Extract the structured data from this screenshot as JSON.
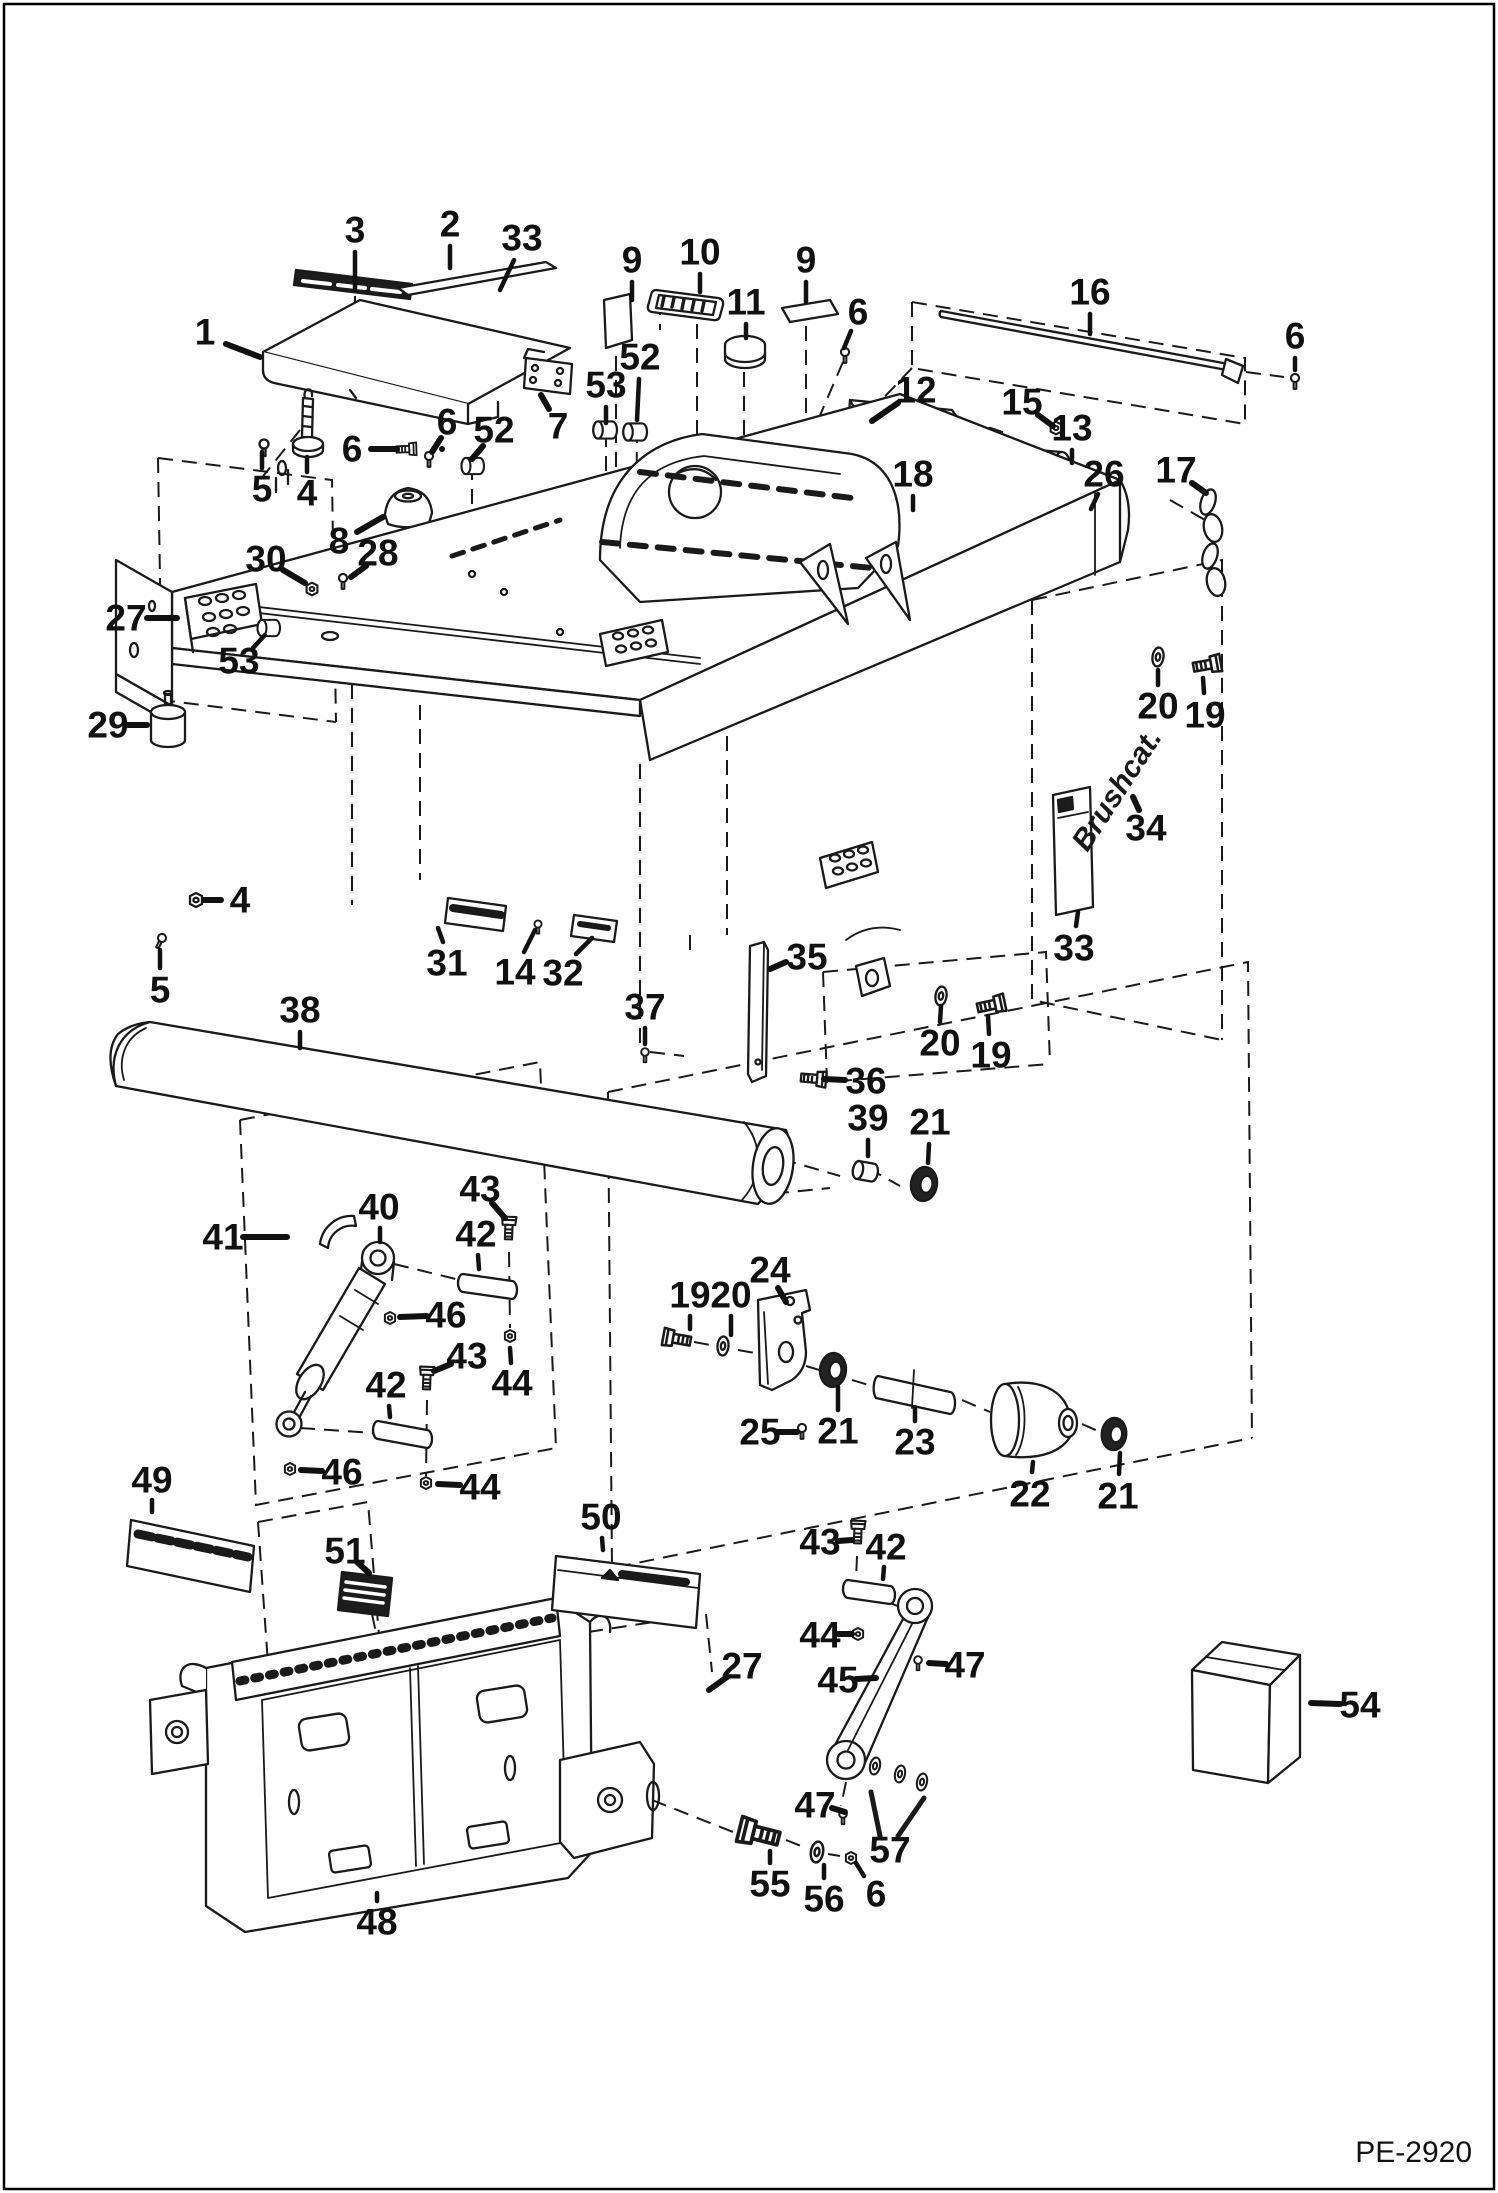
{
  "page": {
    "background": "#ffffff",
    "line_color": "#1a1a1a",
    "border_color": "#000000"
  },
  "footer": {
    "code": "PE-2920"
  },
  "brand": {
    "logo_text": "Brushcat."
  },
  "diagram": {
    "type": "exploded-parts-diagram",
    "part_numbers_shown": [
      1,
      2,
      3,
      4,
      5,
      6,
      7,
      8,
      9,
      10,
      11,
      12,
      13,
      14,
      15,
      16,
      17,
      18,
      19,
      20,
      21,
      22,
      23,
      24,
      25,
      26,
      27,
      28,
      29,
      30,
      31,
      32,
      33,
      34,
      35,
      36,
      37,
      38,
      39,
      40,
      41,
      42,
      43,
      44,
      45,
      46,
      47,
      48,
      49,
      50,
      51,
      52,
      53,
      54,
      55,
      56,
      57
    ],
    "callouts": [
      {
        "label": "1",
        "x": 205,
        "y": 332,
        "leaders": [
          [
            226,
            344,
            260,
            357
          ]
        ],
        "thick": true
      },
      {
        "label": "3",
        "x": 355,
        "y": 230,
        "leaders": [
          [
            355,
            252,
            355,
            290
          ]
        ]
      },
      {
        "label": "2",
        "x": 450,
        "y": 224,
        "leaders": [
          [
            450,
            246,
            450,
            268
          ]
        ]
      },
      {
        "label": "33",
        "x": 522,
        "y": 238,
        "leaders": [
          [
            514,
            260,
            500,
            290
          ]
        ]
      },
      {
        "label": "9",
        "x": 632,
        "y": 260,
        "leaders": [
          [
            632,
            282,
            632,
            300
          ]
        ]
      },
      {
        "label": "10",
        "x": 700,
        "y": 252,
        "leaders": [
          [
            700,
            274,
            700,
            292
          ]
        ]
      },
      {
        "label": "11",
        "x": 746,
        "y": 302,
        "leaders": [
          [
            746,
            324,
            746,
            338
          ]
        ]
      },
      {
        "label": "9",
        "x": 806,
        "y": 260,
        "leaders": [
          [
            806,
            282,
            806,
            302
          ]
        ]
      },
      {
        "label": "6",
        "x": 858,
        "y": 312,
        "leaders": [
          [
            851,
            331,
            844,
            348
          ]
        ]
      },
      {
        "label": "16",
        "x": 1090,
        "y": 292,
        "leaders": [
          [
            1090,
            314,
            1090,
            334
          ]
        ]
      },
      {
        "label": "6",
        "x": 1295,
        "y": 336,
        "leaders": [
          [
            1295,
            358,
            1295,
            370
          ]
        ]
      },
      {
        "label": "12",
        "x": 916,
        "y": 390,
        "leaders": [
          [
            898,
            403,
            872,
            421
          ]
        ],
        "thick": true
      },
      {
        "label": "15",
        "x": 1022,
        "y": 402,
        "leaders": [
          [
            1038,
            415,
            1053,
            426
          ]
        ],
        "thick": true
      },
      {
        "label": "13",
        "x": 1072,
        "y": 428,
        "leaders": [
          [
            1072,
            450,
            1072,
            463
          ]
        ]
      },
      {
        "label": "26",
        "x": 1104,
        "y": 474,
        "leaders": [
          [
            1098,
            494,
            1091,
            509
          ]
        ]
      },
      {
        "label": "17",
        "x": 1176,
        "y": 470,
        "leaders": [
          [
            1192,
            483,
            1206,
            493
          ]
        ],
        "thick": true
      },
      {
        "label": "18",
        "x": 913,
        "y": 474,
        "leaders": [
          [
            913,
            496,
            913,
            510
          ]
        ]
      },
      {
        "label": "5",
        "x": 262,
        "y": 489,
        "leaders": [
          [
            262,
            468,
            262,
            452
          ]
        ]
      },
      {
        "label": "4",
        "x": 307,
        "y": 493,
        "leaders": [
          [
            307,
            472,
            307,
            457
          ]
        ]
      },
      {
        "label": "6",
        "x": 352,
        "y": 449,
        "leaders": [
          [
            371,
            449,
            397,
            449
          ],
          [
            442,
            449,
            442,
            449
          ]
        ],
        "thick": true
      },
      {
        "label": "6",
        "x": 447,
        "y": 422,
        "leaders": [
          [
            441,
            438,
            432,
            452
          ]
        ],
        "thick": true
      },
      {
        "label": "52",
        "x": 494,
        "y": 430,
        "leaders": [
          [
            483,
            446,
            472,
            459
          ]
        ],
        "thick": true
      },
      {
        "label": "53",
        "x": 606,
        "y": 385,
        "leaders": [
          [
            606,
            407,
            606,
            423
          ]
        ]
      },
      {
        "label": "52",
        "x": 640,
        "y": 357,
        "leaders": [
          [
            639,
            379,
            637,
            420
          ]
        ]
      },
      {
        "label": "7",
        "x": 558,
        "y": 426,
        "leaders": [
          [
            549,
            409,
            541,
            395
          ]
        ],
        "thick": true
      },
      {
        "label": "8",
        "x": 339,
        "y": 541,
        "leaders": [
          [
            357,
            532,
            383,
            517
          ]
        ],
        "thick": true
      },
      {
        "label": "28",
        "x": 378,
        "y": 553,
        "leaders": [
          [
            366,
            566,
            351,
            577
          ]
        ],
        "thick": true
      },
      {
        "label": "30",
        "x": 266,
        "y": 559,
        "leaders": [
          [
            283,
            570,
            305,
            583
          ]
        ],
        "thick": true
      },
      {
        "label": "27",
        "x": 126,
        "y": 618,
        "leaders": [
          [
            147,
            618,
            177,
            618
          ]
        ],
        "thick": true
      },
      {
        "label": "53",
        "x": 239,
        "y": 661,
        "leaders": [
          [
            253,
            648,
            265,
            635
          ]
        ]
      },
      {
        "label": "29",
        "x": 108,
        "y": 725,
        "leaders": [
          [
            128,
            725,
            147,
            725
          ],
          [
            0,
            0,
            0,
            0
          ]
        ],
        "thick": true
      },
      {
        "label": "4",
        "x": 240,
        "y": 900,
        "leaders": [
          [
            221,
            900,
            204,
            900
          ]
        ],
        "thick": true
      },
      {
        "label": "5",
        "x": 160,
        "y": 990,
        "leaders": [
          [
            160,
            968,
            160,
            950
          ]
        ]
      },
      {
        "label": "31",
        "x": 447,
        "y": 963,
        "leaders": [
          [
            443,
            942,
            438,
            928
          ]
        ]
      },
      {
        "label": "14",
        "x": 515,
        "y": 972,
        "leaders": [
          [
            524,
            952,
            535,
            930
          ]
        ]
      },
      {
        "label": "32",
        "x": 563,
        "y": 973,
        "leaders": [
          [
            576,
            954,
            592,
            938
          ]
        ]
      },
      {
        "label": "35",
        "x": 807,
        "y": 957,
        "leaders": [
          [
            786,
            962,
            770,
            969
          ]
        ],
        "thick": true
      },
      {
        "label": "36",
        "x": 866,
        "y": 1081,
        "leaders": [
          [
            845,
            1080,
            824,
            1079
          ]
        ],
        "thick": true
      },
      {
        "label": "37",
        "x": 645,
        "y": 1007,
        "leaders": [
          [
            645,
            1028,
            645,
            1044
          ]
        ]
      },
      {
        "label": "38",
        "x": 300,
        "y": 1010,
        "leaders": [
          [
            300,
            1032,
            300,
            1048
          ]
        ]
      },
      {
        "label": "20",
        "x": 1158,
        "y": 706,
        "leaders": [
          [
            1158,
            685,
            1158,
            670
          ]
        ]
      },
      {
        "label": "19",
        "x": 1205,
        "y": 715,
        "leaders": [
          [
            1204,
            693,
            1203,
            678
          ]
        ]
      },
      {
        "label": "34",
        "x": 1146,
        "y": 828,
        "leaders": [
          [
            1139,
            810,
            1133,
            797
          ]
        ],
        "thick": true
      },
      {
        "label": "33",
        "x": 1074,
        "y": 948,
        "leaders": [
          [
            1076,
            926,
            1078,
            912
          ]
        ]
      },
      {
        "label": "20",
        "x": 940,
        "y": 1043,
        "leaders": [
          [
            940,
            1022,
            941,
            1006
          ]
        ]
      },
      {
        "label": "19",
        "x": 991,
        "y": 1055,
        "leaders": [
          [
            989,
            1034,
            988,
            1016
          ]
        ]
      },
      {
        "label": "39",
        "x": 868,
        "y": 1118,
        "leaders": [
          [
            868,
            1140,
            868,
            1156
          ]
        ]
      },
      {
        "label": "21",
        "x": 930,
        "y": 1122,
        "leaders": [
          [
            929,
            1144,
            928,
            1163
          ]
        ]
      },
      {
        "label": "24",
        "x": 770,
        "y": 1270,
        "leaders": [
          [
            778,
            1288,
            786,
            1302
          ]
        ],
        "thick": true
      },
      {
        "label": "19",
        "x": 690,
        "y": 1295,
        "leaders": [
          [
            690,
            1316,
            690,
            1329
          ]
        ]
      },
      {
        "label": "20",
        "x": 731,
        "y": 1295,
        "leaders": [
          [
            731,
            1316,
            731,
            1335
          ]
        ]
      },
      {
        "label": "25",
        "x": 760,
        "y": 1432,
        "leaders": [
          [
            778,
            1432,
            797,
            1432
          ]
        ],
        "thick": true
      },
      {
        "label": "21",
        "x": 838,
        "y": 1431,
        "leaders": [
          [
            838,
            1410,
            838,
            1387
          ]
        ]
      },
      {
        "label": "23",
        "x": 915,
        "y": 1442,
        "leaders": [
          [
            915,
            1421,
            915,
            1407
          ]
        ]
      },
      {
        "label": "22",
        "x": 1030,
        "y": 1494,
        "leaders": [
          [
            1032,
            1472,
            1033,
            1462
          ]
        ]
      },
      {
        "label": "21",
        "x": 1118,
        "y": 1496,
        "leaders": [
          [
            1119,
            1474,
            1120,
            1453
          ]
        ]
      },
      {
        "label": "41",
        "x": 223,
        "y": 1237,
        "leaders": [
          [
            243,
            1237,
            287,
            1237
          ]
        ],
        "thick": true
      },
      {
        "label": "40",
        "x": 379,
        "y": 1207,
        "leaders": [
          [
            380,
            1228,
            380,
            1242
          ]
        ]
      },
      {
        "label": "43",
        "x": 480,
        "y": 1189,
        "leaders": [
          [
            492,
            1203,
            505,
            1218
          ]
        ],
        "thick": true
      },
      {
        "label": "42",
        "x": 476,
        "y": 1234,
        "leaders": [
          [
            478,
            1255,
            479,
            1269
          ]
        ]
      },
      {
        "label": "46",
        "x": 446,
        "y": 1315,
        "leaders": [
          [
            427,
            1316,
            400,
            1317
          ]
        ],
        "thick": true
      },
      {
        "label": "43",
        "x": 467,
        "y": 1356,
        "leaders": [
          [
            451,
            1364,
            434,
            1371
          ]
        ],
        "thick": true
      },
      {
        "label": "42",
        "x": 386,
        "y": 1385,
        "leaders": [
          [
            389,
            1406,
            390,
            1417
          ]
        ]
      },
      {
        "label": "44",
        "x": 512,
        "y": 1383,
        "leaders": [
          [
            511,
            1363,
            510,
            1348
          ]
        ]
      },
      {
        "label": "46",
        "x": 342,
        "y": 1472,
        "leaders": [
          [
            322,
            1471,
            301,
            1470
          ]
        ],
        "thick": true
      },
      {
        "label": "44",
        "x": 480,
        "y": 1487,
        "leaders": [
          [
            460,
            1485,
            438,
            1484
          ]
        ],
        "thick": true
      },
      {
        "label": "49",
        "x": 152,
        "y": 1480,
        "leaders": [
          [
            152,
            1500,
            152,
            1512
          ]
        ]
      },
      {
        "label": "51",
        "x": 345,
        "y": 1551,
        "leaders": [
          [
            357,
            1562,
            369,
            1573
          ]
        ],
        "thick": true
      },
      {
        "label": "50",
        "x": 601,
        "y": 1517,
        "leaders": [
          [
            602,
            1538,
            603,
            1550
          ]
        ]
      },
      {
        "label": "43",
        "x": 820,
        "y": 1542,
        "leaders": [
          [
            838,
            1541,
            852,
            1540
          ]
        ],
        "thick": true
      },
      {
        "label": "42",
        "x": 886,
        "y": 1547,
        "leaders": [
          [
            884,
            1567,
            883,
            1579
          ]
        ]
      },
      {
        "label": "44",
        "x": 820,
        "y": 1635,
        "leaders": [
          [
            838,
            1634,
            852,
            1634
          ]
        ],
        "thick": true
      },
      {
        "label": "45",
        "x": 838,
        "y": 1680,
        "leaders": [
          [
            856,
            1679,
            876,
            1678
          ]
        ],
        "thick": true
      },
      {
        "label": "47",
        "x": 965,
        "y": 1665,
        "leaders": [
          [
            946,
            1664,
            929,
            1663
          ]
        ],
        "thick": true
      },
      {
        "label": "27",
        "x": 742,
        "y": 1666,
        "leaders": [
          [
            727,
            1677,
            709,
            1690
          ]
        ],
        "thick": true
      },
      {
        "label": "47",
        "x": 815,
        "y": 1805,
        "leaders": [
          [
            832,
            1808,
            845,
            1812
          ]
        ],
        "thick": true
      },
      {
        "label": "57",
        "x": 890,
        "y": 1850,
        "leaders": []
      },
      {
        "label": "55",
        "x": 770,
        "y": 1884,
        "leaders": [
          [
            770,
            1863,
            770,
            1851
          ]
        ]
      },
      {
        "label": "56",
        "x": 824,
        "y": 1899,
        "leaders": [
          [
            824,
            1878,
            824,
            1865
          ]
        ]
      },
      {
        "label": "6",
        "x": 876,
        "y": 1894,
        "leaders": [
          [
            864,
            1876,
            856,
            1863
          ]
        ]
      },
      {
        "label": "54",
        "x": 1360,
        "y": 1705,
        "leaders": [
          [
            1340,
            1704,
            1311,
            1703
          ]
        ],
        "thick": true
      },
      {
        "label": "48",
        "x": 377,
        "y": 1922,
        "leaders": [
          [
            377,
            1901,
            377,
            1893
          ]
        ]
      }
    ]
  }
}
